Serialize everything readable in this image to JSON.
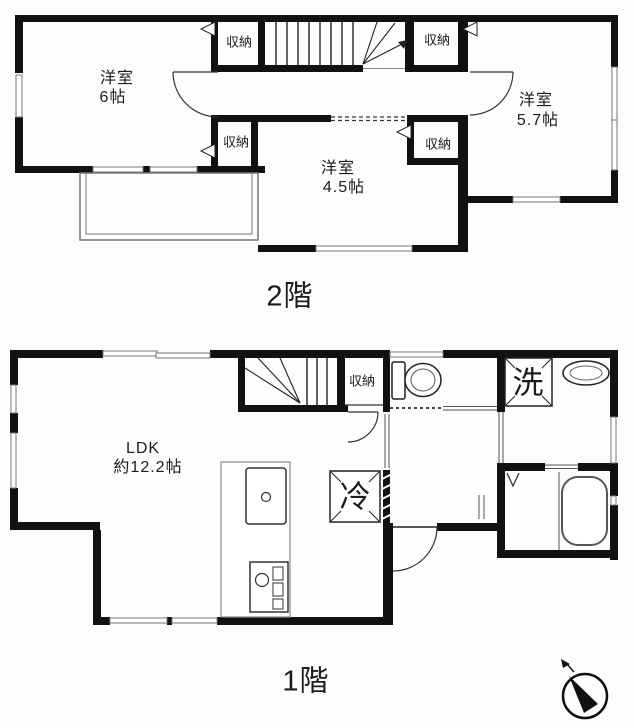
{
  "colors": {
    "wall": "#111111",
    "thin_line": "#666666",
    "background": "#fdfdfc",
    "text": "#1c1c1c"
  },
  "floor2": {
    "caption": "2階",
    "rooms": {
      "west": {
        "name": "洋室",
        "size": "6帖"
      },
      "east": {
        "name": "洋室",
        "size": "5.7帖"
      },
      "center": {
        "name": "洋室",
        "size": "4.5帖"
      }
    },
    "closets": {
      "top_left": "収納",
      "top_right": "収納",
      "mid_left": "収納",
      "mid_right": "収納"
    }
  },
  "floor1": {
    "caption": "1階",
    "rooms": {
      "ldk": {
        "name": "LDK",
        "size": "約12.2帖"
      }
    },
    "closet": "収納",
    "laundry": "洗",
    "refrigerator": "冷"
  },
  "icons": {
    "compass": "compass-north-icon",
    "stairs_2f": "stairs-icon",
    "stairs_1f": "stairs-icon",
    "toilet": "toilet-icon",
    "bathtub": "bathtub-icon",
    "sink": "vanity-sink-icon",
    "kitchen": "kitchen-counter-icon",
    "balcony": "balcony-outline"
  }
}
